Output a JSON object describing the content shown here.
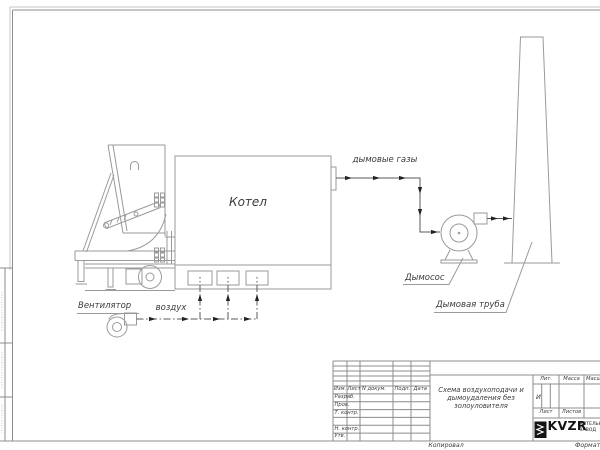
{
  "schematic": {
    "boiler_label": "Котел",
    "flue_gas_label": "дымовые газы",
    "exhauster_label": "Дымосос",
    "chimney_label": "Дымовая труба",
    "fan_label": "Вентилятор",
    "air_label": "воздух"
  },
  "title_block": {
    "doc_title_lines": [
      "Схема воздухоподачи и",
      "дымоудаления без",
      "золоуловителя"
    ],
    "revision_header": [
      "Изм.",
      "Лист",
      "N докум.",
      "Подп.",
      "Дата"
    ],
    "signature_rows": [
      "Разраб.",
      "Пров.",
      "Т. контр.",
      "Н. контр.",
      "Утв."
    ],
    "lit_header": "Лит.",
    "mass_header": "Масса",
    "scale_header": "Масштаб",
    "lit_value": "И",
    "sheet_label": "Лист",
    "sheets_label": "Листов",
    "logo_text": "KVZR",
    "logo_caption_lines": [
      "КОТЕЛЬНЫЙ",
      "ЗАВОД"
    ]
  },
  "footer": {
    "copied_by_label": "Копировал",
    "format_label": "Формат"
  },
  "colors": {
    "line": "#9a9a9a",
    "flow": "#5a5a5a",
    "arrow": "#222222",
    "frame": "#c6c6c6",
    "tbline": "#8c8c8c",
    "text": "#3b3b3b",
    "logo": "#141414"
  }
}
